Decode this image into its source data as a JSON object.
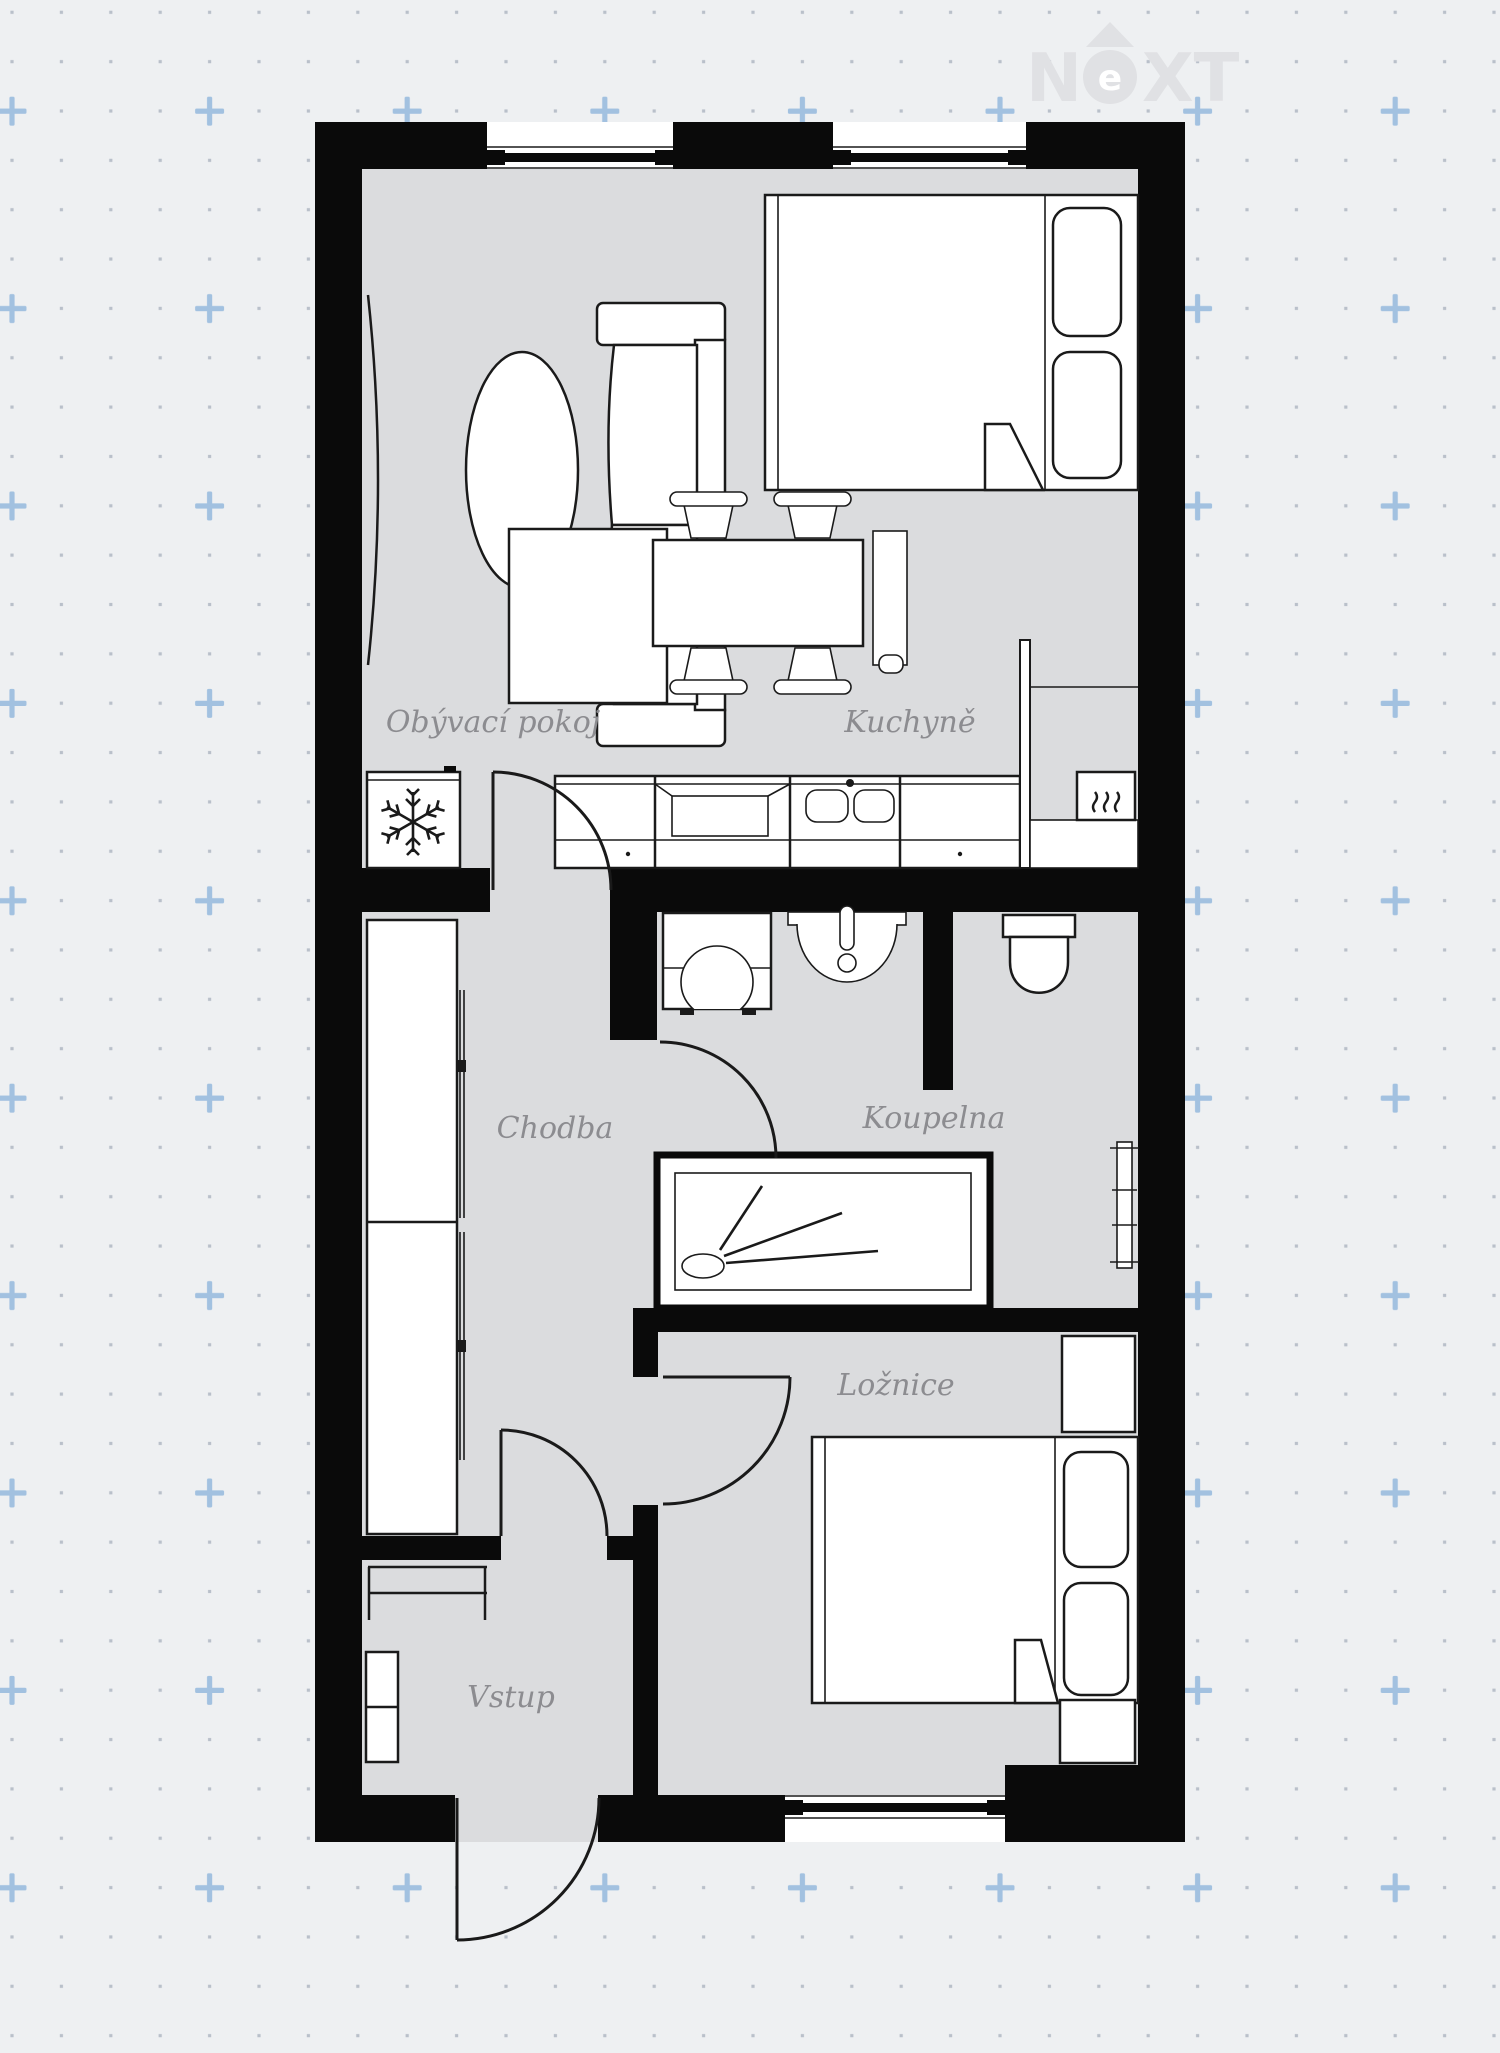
{
  "watermark": {
    "letter_n": "N",
    "letter_e": "e",
    "letters_xt": "XT"
  },
  "rooms": {
    "living_room": {
      "label": "Obývací pokoj"
    },
    "kitchen": {
      "label": "Kuchyně"
    },
    "hallway": {
      "label": "Chodba"
    },
    "bathroom": {
      "label": "Koupelna"
    },
    "bedroom": {
      "label": "Ložnice"
    },
    "entrance": {
      "label": "Vstup"
    }
  },
  "icons": {
    "snowflake": "fridge-freezer symbol",
    "heat_waves": "cooker heat symbol",
    "shower_spray": "shower spray symbol"
  },
  "colors": {
    "background": "#eef0f2",
    "floor": "#dbdcde",
    "wall": "#0a0a0a",
    "furniture_stroke": "#1a1a1a",
    "label_text": "#8c8c90",
    "grid_dot": "#b9c0ca",
    "grid_plus": "#a2c1e0",
    "watermark": "#e0e1e4"
  }
}
